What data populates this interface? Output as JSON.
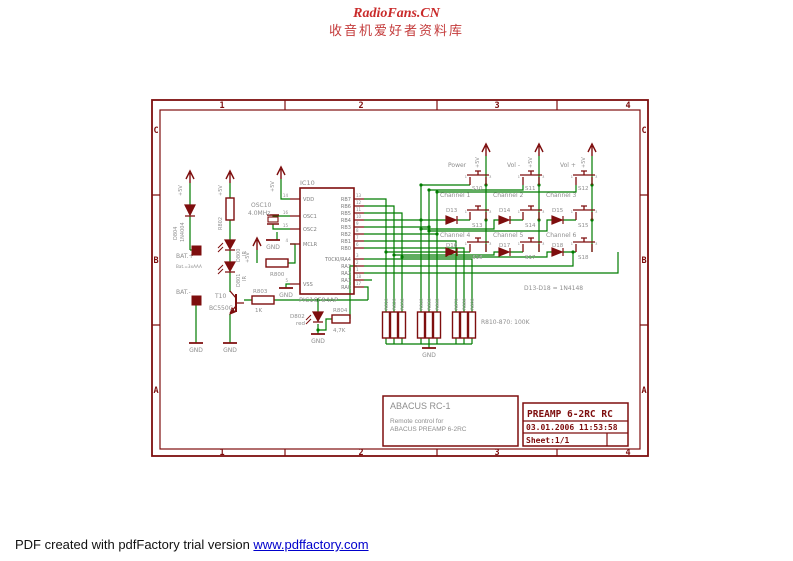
{
  "header": {
    "line1": "RadioFans.CN",
    "line2": "收音机爱好者资料库"
  },
  "footer": {
    "prefix": "PDF created with pdfFactory trial version ",
    "link": "www.pdffactory.com"
  },
  "frame": {
    "cols": [
      "1",
      "2",
      "3",
      "4"
    ],
    "rows": [
      "C",
      "B",
      "A"
    ]
  },
  "labels": {
    "vcc": "+5V",
    "gnd": "GND"
  },
  "colors": {
    "schematic_red": "#7e0e0e",
    "wire_green": "#007c00",
    "label_gray": "#8e8e8e",
    "header_red": "#c92a2a",
    "link_blue": "#0000cc"
  },
  "sch": {
    "d804": {
      "name": "D804",
      "value": "1N4004"
    },
    "bat": {
      "plus": "BAT.+",
      "note": "Bat.=3xAAA",
      "minus": "BAT.-"
    },
    "r802": {
      "name": "R802"
    },
    "d800": {
      "name": "D800",
      "value": "IR"
    },
    "d801": {
      "name": "D801",
      "value": "IR"
    },
    "t10": {
      "name": "T10",
      "value": "BC550C"
    },
    "osc": {
      "name": "OSC10",
      "value": "4.0MHz"
    },
    "r800": {
      "name": "R800"
    },
    "r803": {
      "name": "R803",
      "value": "1K"
    },
    "d802": {
      "name": "D802",
      "value": "red"
    },
    "r804": {
      "name": "R804",
      "value": "4,7K"
    },
    "ic": {
      "name": "IC10",
      "part": "PIC16F84AP",
      "left": [
        {
          "n": "14",
          "l": "VDD"
        },
        {
          "n": "16",
          "l": "OSC1"
        },
        {
          "n": "15",
          "l": "OSC2"
        },
        {
          "n": "4",
          "l": "MCLR"
        },
        {
          "n": "5",
          "l": "VSS"
        }
      ],
      "right": [
        {
          "n": "13",
          "l": "RB7"
        },
        {
          "n": "12",
          "l": "RB6"
        },
        {
          "n": "11",
          "l": "RB5"
        },
        {
          "n": "10",
          "l": "RB4"
        },
        {
          "n": "9",
          "l": "RB3"
        },
        {
          "n": "8",
          "l": "RB2"
        },
        {
          "n": "7",
          "l": "RB1"
        },
        {
          "n": "6",
          "l": "RB0"
        },
        {
          "n": "3",
          "l": "T0CKI/RA4"
        },
        {
          "n": "2",
          "l": "RA3"
        },
        {
          "n": "1",
          "l": "RA2"
        },
        {
          "n": "18",
          "l": "RA1"
        },
        {
          "n": "17",
          "l": "RA0"
        }
      ]
    },
    "sw": {
      "pins": [
        "1",
        "3"
      ],
      "top": [
        {
          "label": "Power",
          "name": "S10"
        },
        {
          "label": "Vol -",
          "name": "S11"
        },
        {
          "label": "Vol +",
          "name": "S12"
        }
      ],
      "mid": [
        {
          "label": "Channel 1",
          "diode": "D13",
          "name": "S13"
        },
        {
          "label": "Channel 2",
          "diode": "D14",
          "name": "S14"
        },
        {
          "label": "Channel 3",
          "diode": "D15",
          "name": "S15"
        }
      ],
      "bot": [
        {
          "label": "Channel 4",
          "diode": "D16",
          "name": "S16"
        },
        {
          "label": "Channel 5",
          "diode": "D17",
          "name": "S17"
        },
        {
          "label": "Channel 6",
          "diode": "D18",
          "name": "S18"
        }
      ]
    },
    "diode_note": "D13-D18 = 1N4148",
    "net": {
      "labels": [
        "R810",
        "R820",
        "R830",
        "R840",
        "R850",
        "R860",
        "R870",
        "R880",
        "R890"
      ],
      "note": "R810-870: 100K"
    },
    "tb": {
      "title": "ABACUS RC-1",
      "sub1": "Remote control for",
      "sub2": "ABACUS PREAMP 6-2RC",
      "doc": "PREAMP 6-2RC RC",
      "date": "03.01.2006 11:53:58",
      "sheet": "Sheet:1/1"
    }
  }
}
